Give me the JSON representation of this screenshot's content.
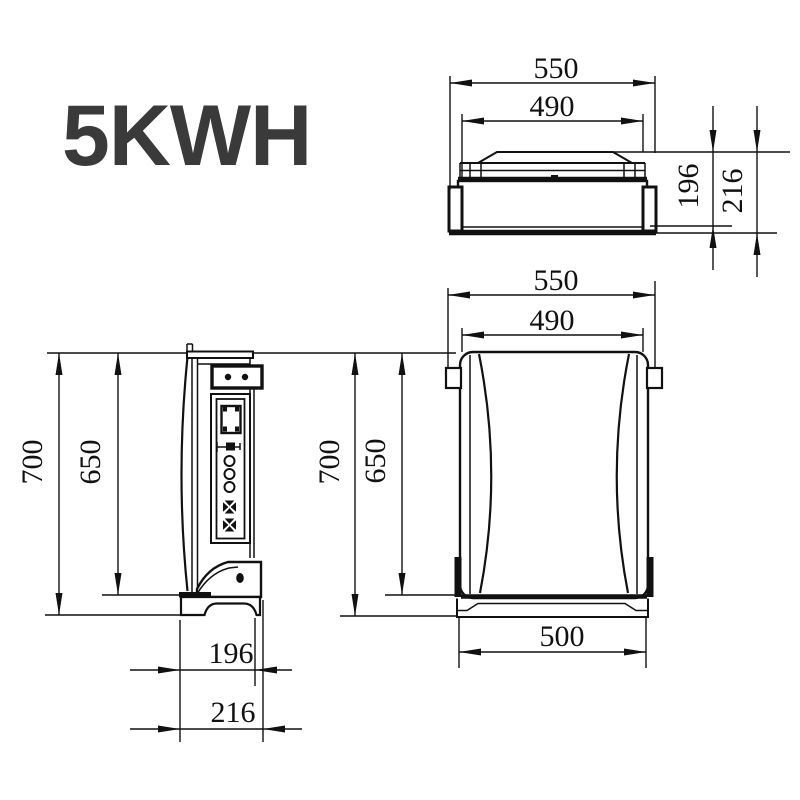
{
  "title": "5KWH",
  "colors": {
    "line": "#111111",
    "title": "#3a3a3a"
  },
  "views": {
    "top": {
      "label": "top-view",
      "width_outer": "550",
      "width_inner": "490",
      "depth_body": "196",
      "depth_total": "216"
    },
    "side": {
      "label": "side-view",
      "height_total": "700",
      "height_body": "650",
      "depth_body": "196",
      "depth_total": "216"
    },
    "front": {
      "label": "front-view",
      "width_outer": "550",
      "width_inner": "490",
      "height_total": "700",
      "height_body": "650",
      "base_width": "500"
    }
  }
}
